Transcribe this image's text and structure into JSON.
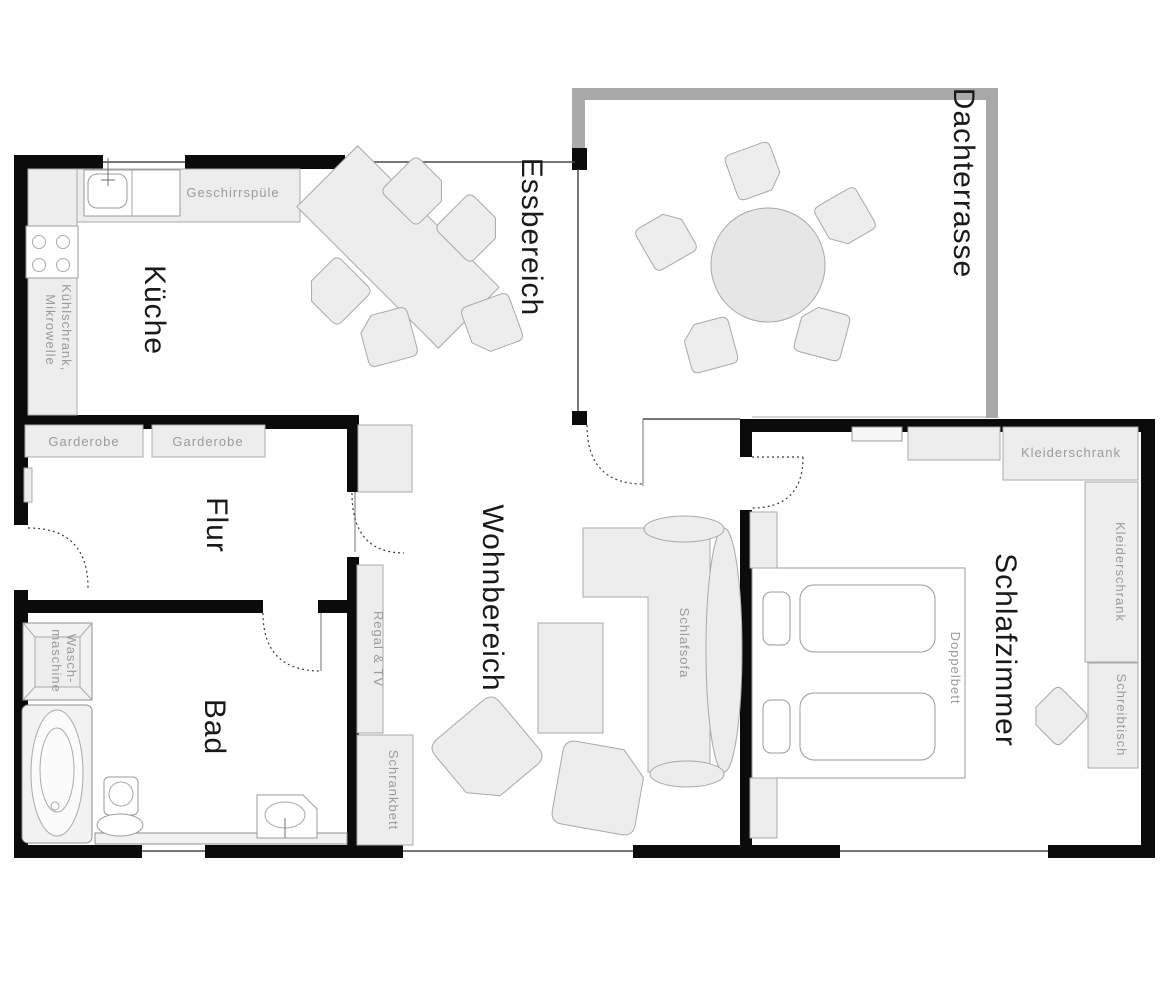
{
  "rooms": {
    "kueche": "Küche",
    "essbereich": "Essbereich",
    "dachterrasse": "Dachterrasse",
    "flur": "Flur",
    "bad": "Bad",
    "wohnbereich": "Wohnbereich",
    "schlafzimmer": "Schlafzimmer"
  },
  "labels": {
    "geschirrspuele": "Geschirrspüle",
    "kuehlschrank_line1": "Kühlschrank,",
    "kuehlschrank_line2": "Mikrowelle",
    "garderobe_1": "Garderobe",
    "garderobe_2": "Garderobe",
    "waschmaschine_line1": "Wasch-",
    "waschmaschine_line2": "maschine",
    "regal_tv": "Regal & TV",
    "schrankbett": "Schrankbett",
    "schlafsofa": "Schlafsofa",
    "doppelbett": "Doppelbett",
    "kleiderschrank_top": "Kleiderschrank",
    "kleiderschrank_side": "Kleiderschrank",
    "schreibtisch": "Schreibtisch"
  },
  "colors": {
    "wall": "#0b0b0b",
    "terrace_wall": "#a9a9a9",
    "furniture_fill": "#ededed",
    "furniture_stroke": "#a9a9a9",
    "room_label": "#1a1a1a",
    "furniture_label": "#9b9b9b",
    "background": "#ffffff"
  }
}
